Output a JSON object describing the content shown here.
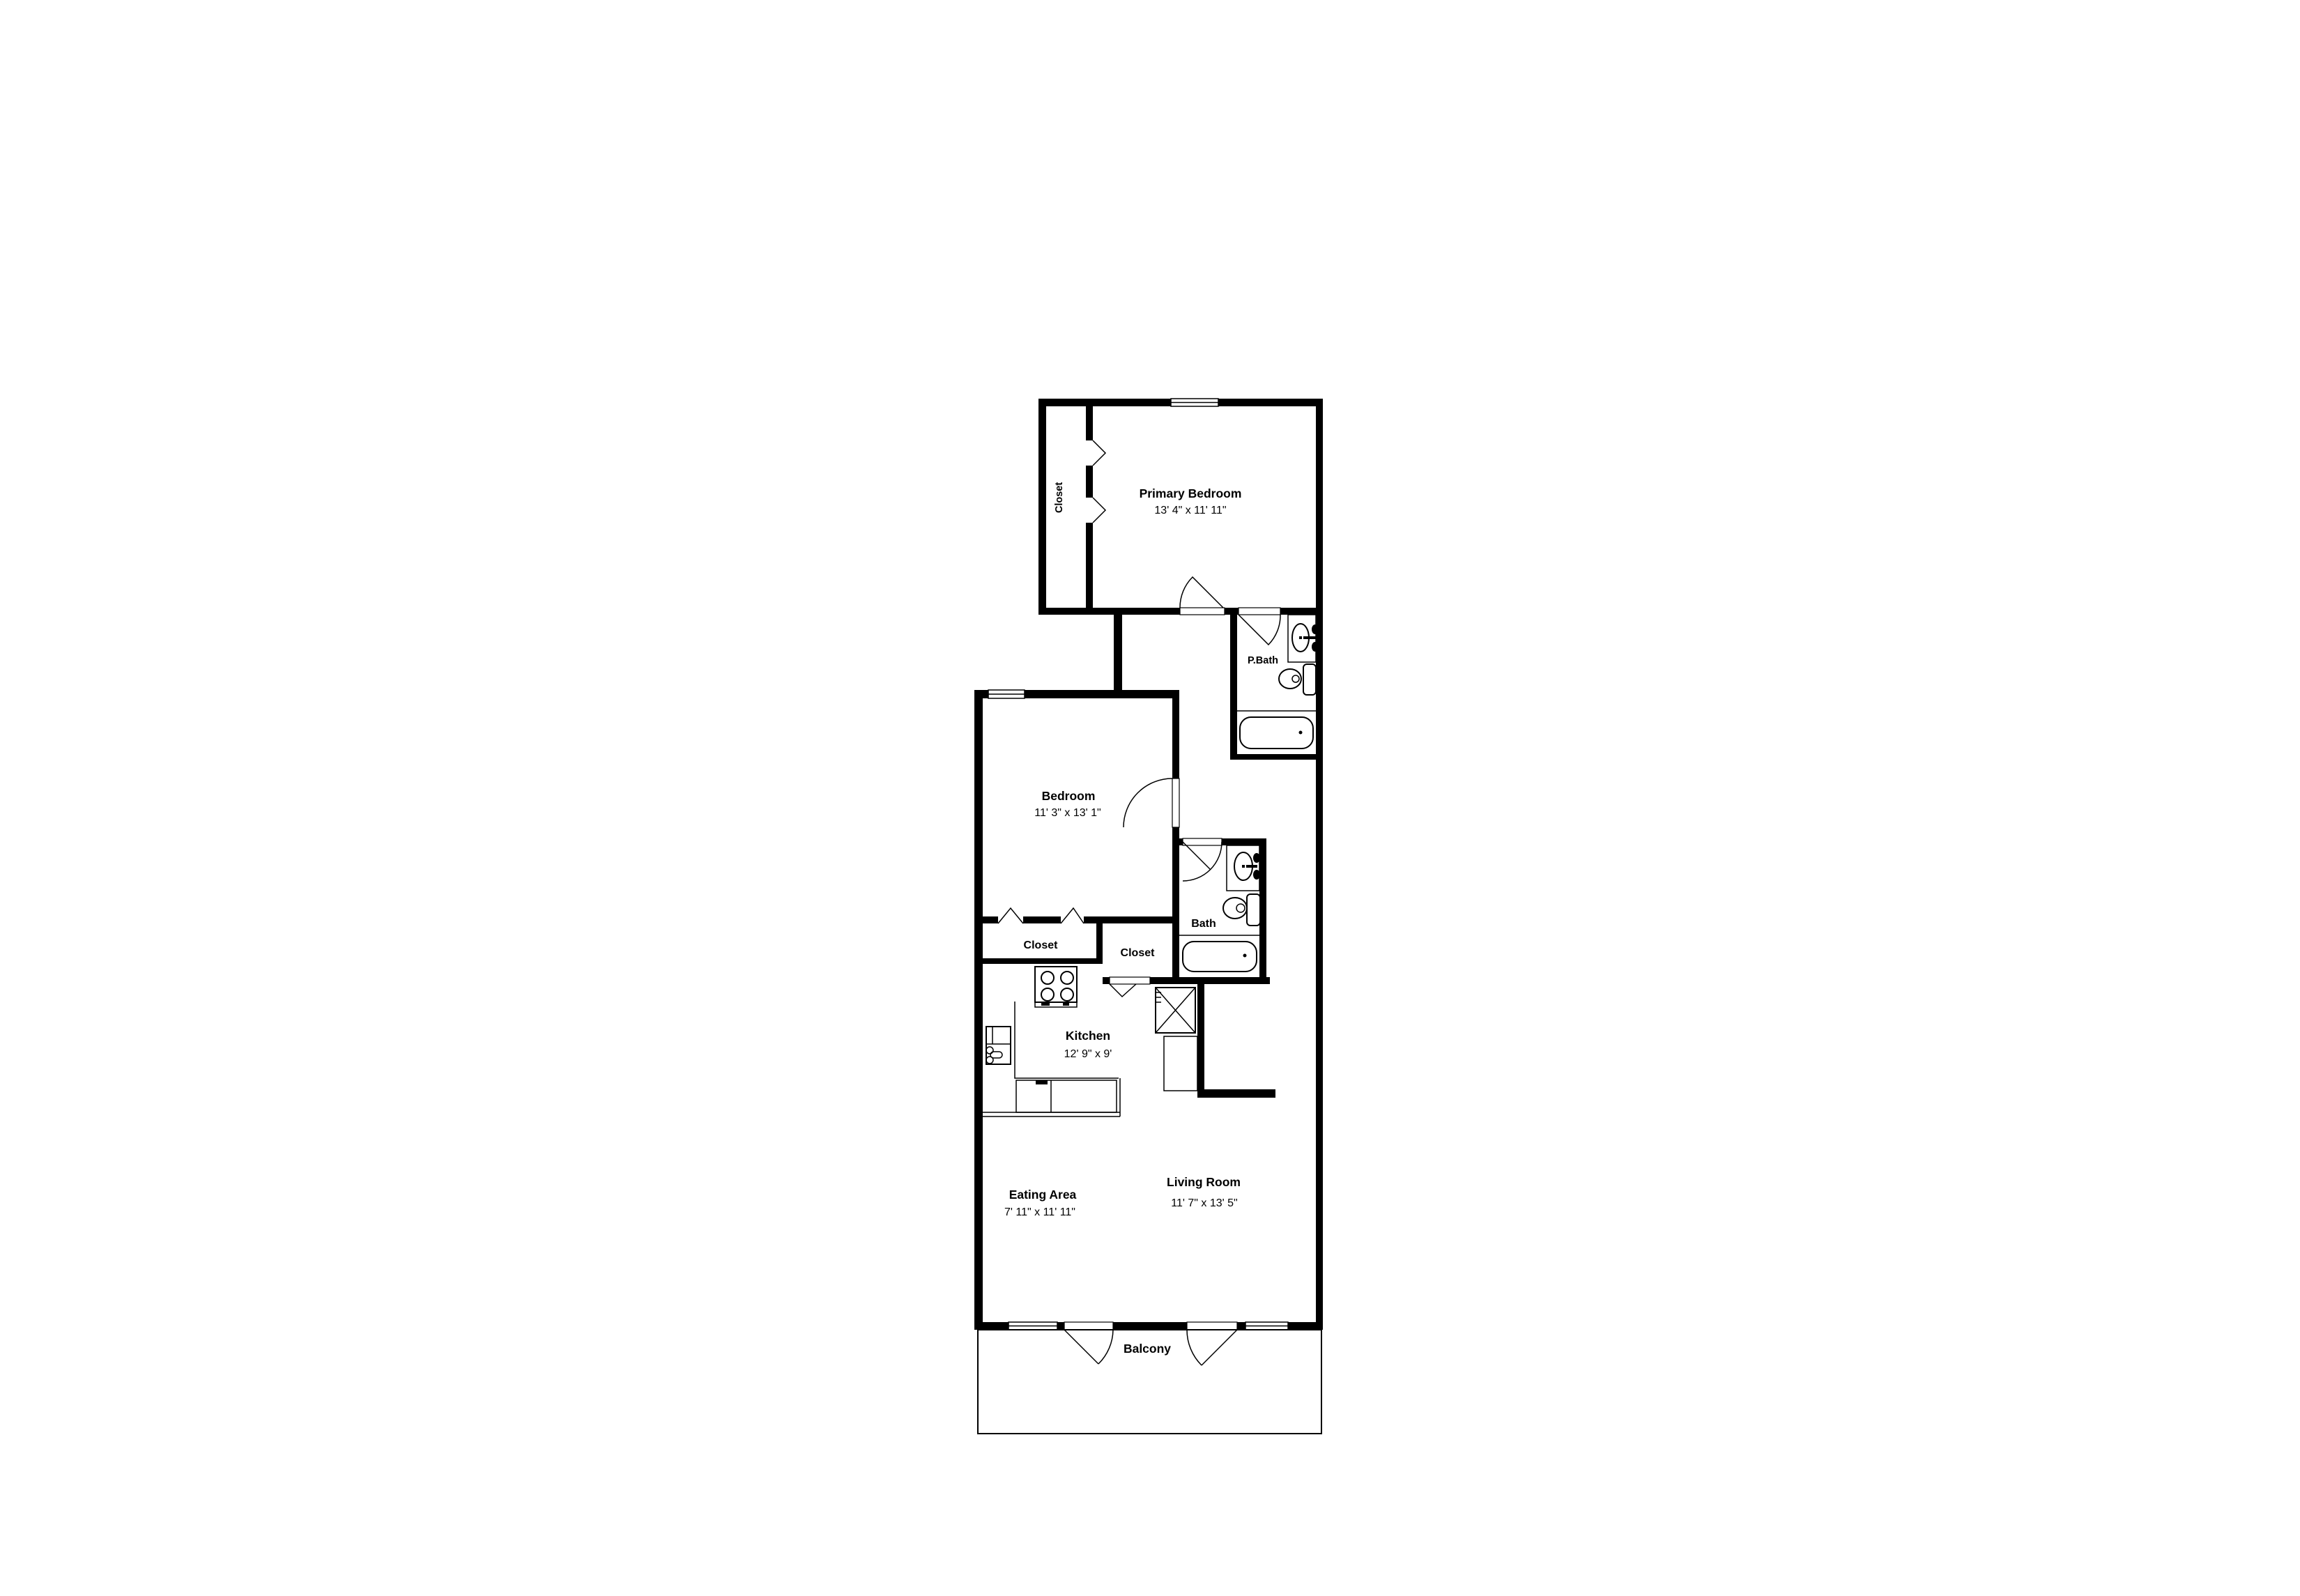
{
  "plan": {
    "type": "residential-floor-plan",
    "colors": {
      "wall": "#000000",
      "background": "#ffffff",
      "line": "#000000"
    },
    "rooms": {
      "primary_bedroom": {
        "label": "Primary Bedroom",
        "dims": "13' 4\" x 11' 11\""
      },
      "primary_closet": {
        "label": "Closet"
      },
      "primary_bath": {
        "label": "P.Bath"
      },
      "bedroom": {
        "label": "Bedroom",
        "dims": "11' 3\" x 13' 1\""
      },
      "bath": {
        "label": "Bath"
      },
      "bedroom_closet": {
        "label": "Closet"
      },
      "hall_closet": {
        "label": "Closet"
      },
      "kitchen": {
        "label": "Kitchen",
        "dims": "12' 9\" x 9'"
      },
      "eating_area": {
        "label": "Eating Area",
        "dims": "7' 11\" x 11' 11\""
      },
      "living_room": {
        "label": "Living Room",
        "dims": "11' 7\" x 13' 5\""
      },
      "balcony": {
        "label": "Balcony"
      }
    }
  }
}
